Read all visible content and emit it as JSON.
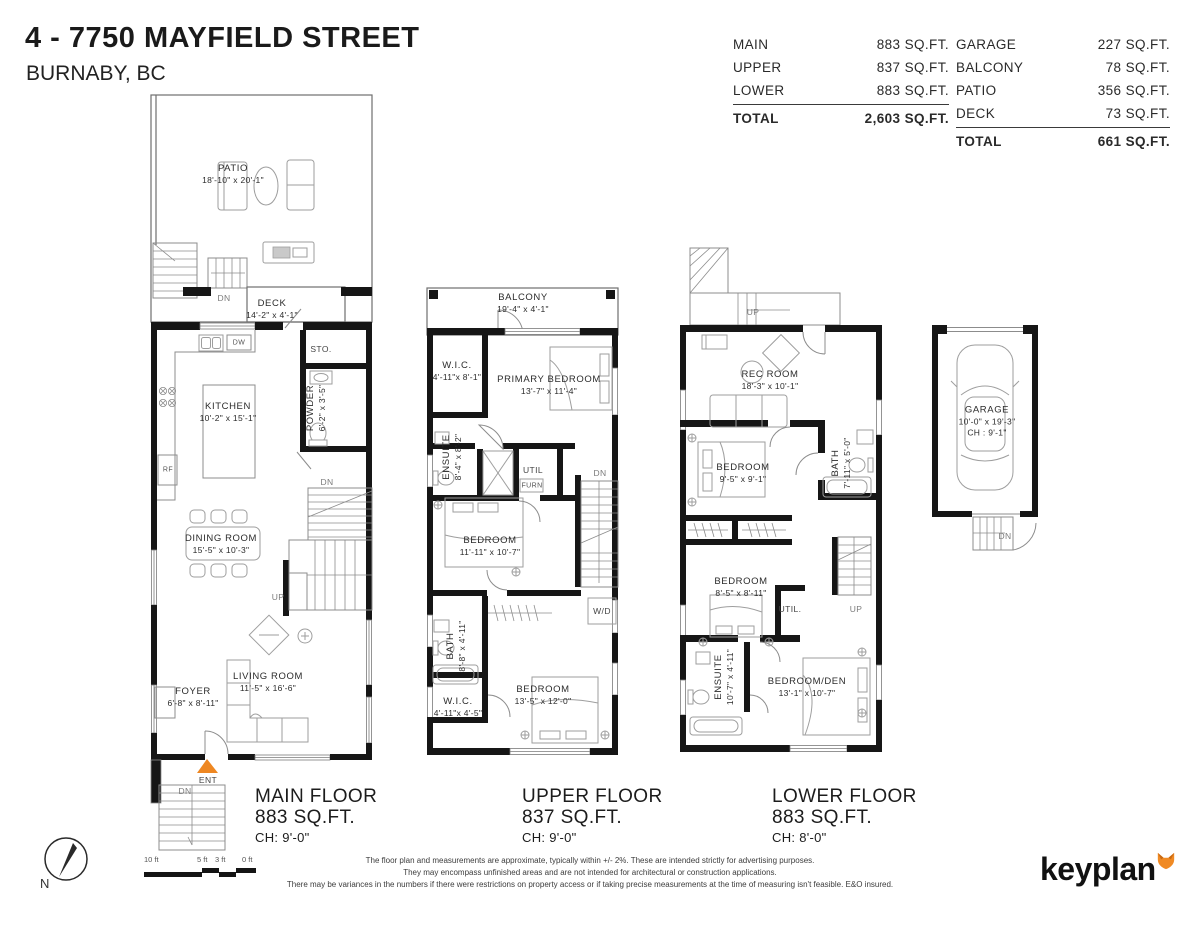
{
  "header": {
    "title": "4 - 7750 MAYFIELD STREET",
    "subtitle": "BURNABY, BC"
  },
  "tables": {
    "interior": {
      "rows": [
        {
          "label": "MAIN",
          "value": "883 SQ.FT."
        },
        {
          "label": "UPPER",
          "value": "837 SQ.FT."
        },
        {
          "label": "LOWER",
          "value": "883 SQ.FT."
        }
      ],
      "total_label": "TOTAL",
      "total_value": "2,603 SQ.FT."
    },
    "exterior": {
      "rows": [
        {
          "label": "GARAGE",
          "value": "227 SQ.FT."
        },
        {
          "label": "BALCONY",
          "value": "78 SQ.FT."
        },
        {
          "label": "PATIO",
          "value": "356 SQ.FT."
        },
        {
          "label": "DECK",
          "value": "73 SQ.FT."
        }
      ],
      "total_label": "TOTAL",
      "total_value": "661 SQ.FT."
    }
  },
  "plans": {
    "main": {
      "footer": {
        "name": "MAIN FLOOR",
        "area": "883 SQ.FT.",
        "ceiling": "CH: 9'-0\""
      },
      "rooms": {
        "patio": {
          "name": "PATIO",
          "dims": "18'-10\" x 20'-1\""
        },
        "deck": {
          "name": "DECK",
          "dims": "14'-2\" x 4'-1\""
        },
        "kitchen": {
          "name": "KITCHEN",
          "dims": "10'-2\" x 15'-1\""
        },
        "dining_room": {
          "name": "DINING ROOM",
          "dims": "15'-5\" x 10'-3\""
        },
        "living_room": {
          "name": "LIVING ROOM",
          "dims": "11'-5\" x 16'-6\""
        },
        "foyer": {
          "name": "FOYER",
          "dims": "6'-8\" x 8'-11\""
        },
        "powder": {
          "name": "POWDER",
          "dims": "6'-2\" x 3'-5\""
        }
      },
      "labels": {
        "storage": "STO.",
        "dw": "DW",
        "rf": "RF",
        "dn_patio": "DN",
        "dn_stairs": "DN",
        "up": "UP",
        "ent": "ENT",
        "dn_entry": "DN"
      }
    },
    "upper": {
      "footer": {
        "name": "UPPER FLOOR",
        "area": "837 SQ.FT.",
        "ceiling": "CH: 9'-0\""
      },
      "rooms": {
        "balcony": {
          "name": "BALCONY",
          "dims": "19'-4\" x 4'-1\""
        },
        "wic_primary": {
          "name": "W.I.C.",
          "dims": "4'-11\"x 8'-1\""
        },
        "primary_bedroom": {
          "name": "PRIMARY BEDROOM",
          "dims": "13'-7\" x 11'-4\""
        },
        "ensuite": {
          "name": "ENSUITE",
          "dims": "8'-4\" x 8'-2\""
        },
        "bedroom_mid": {
          "name": "BEDROOM",
          "dims": "11'-11\" x 10'-7\""
        },
        "bath": {
          "name": "BATH",
          "dims": "8'-8\" x 4'-11\""
        },
        "wic_small": {
          "name": "W.I.C.",
          "dims": "4'-11\"x 4'-5\""
        },
        "bedroom_rear": {
          "name": "BEDROOM",
          "dims": "13'-5\" x 12'-0\""
        }
      },
      "labels": {
        "util": "UTIL",
        "furn": "FURN",
        "dn": "DN",
        "wd": "W/D"
      }
    },
    "lower": {
      "footer": {
        "name": "LOWER FLOOR",
        "area": "883 SQ.FT.",
        "ceiling": "CH: 8'-0\""
      },
      "rooms": {
        "rec_room": {
          "name": "REC ROOM",
          "dims": "18'-3\" x 10'-1\""
        },
        "bedroom_front": {
          "name": "BEDROOM",
          "dims": "9'-5\" x 9'-1\""
        },
        "bath": {
          "name": "BATH",
          "dims": "7'-11\" x 5'-0\""
        },
        "bedroom_mid": {
          "name": "BEDROOM",
          "dims": "8'-5\" x 8'-11\""
        },
        "ensuite": {
          "name": "ENSUITE",
          "dims": "10'-7\" x 4'-11\""
        },
        "bedroom_den": {
          "name": "BEDROOM/DEN",
          "dims": "13'-1\" x 10'-7\""
        }
      },
      "labels": {
        "up_entry": "UP",
        "util": "UTIL.",
        "up_stairs": "UP"
      }
    },
    "garage": {
      "room": {
        "name": "GARAGE",
        "dims": "10'-0\" x 19'-3\"",
        "ceiling": "CH : 9'-1\""
      },
      "labels": {
        "dn": "DN"
      }
    }
  },
  "footer": {
    "compass_label": "N",
    "scale_labels": [
      "10 ft",
      "5 ft",
      "3 ft",
      "0 ft"
    ],
    "disclaimer": [
      "The floor plan and measurements are approximate, typically within +/- 2%. These are intended strictly for advertising purposes.",
      "They may encompass unfinished areas and are not intended for architectural or construction applications.",
      "There may be variances in the numbers if there were restrictions on property access or if taking precise measurements at the time of measuring isn't feasible. E&O insured."
    ],
    "logo_text": "keyplan"
  },
  "colors": {
    "accent": "#EE8722",
    "wall": "#161616"
  }
}
